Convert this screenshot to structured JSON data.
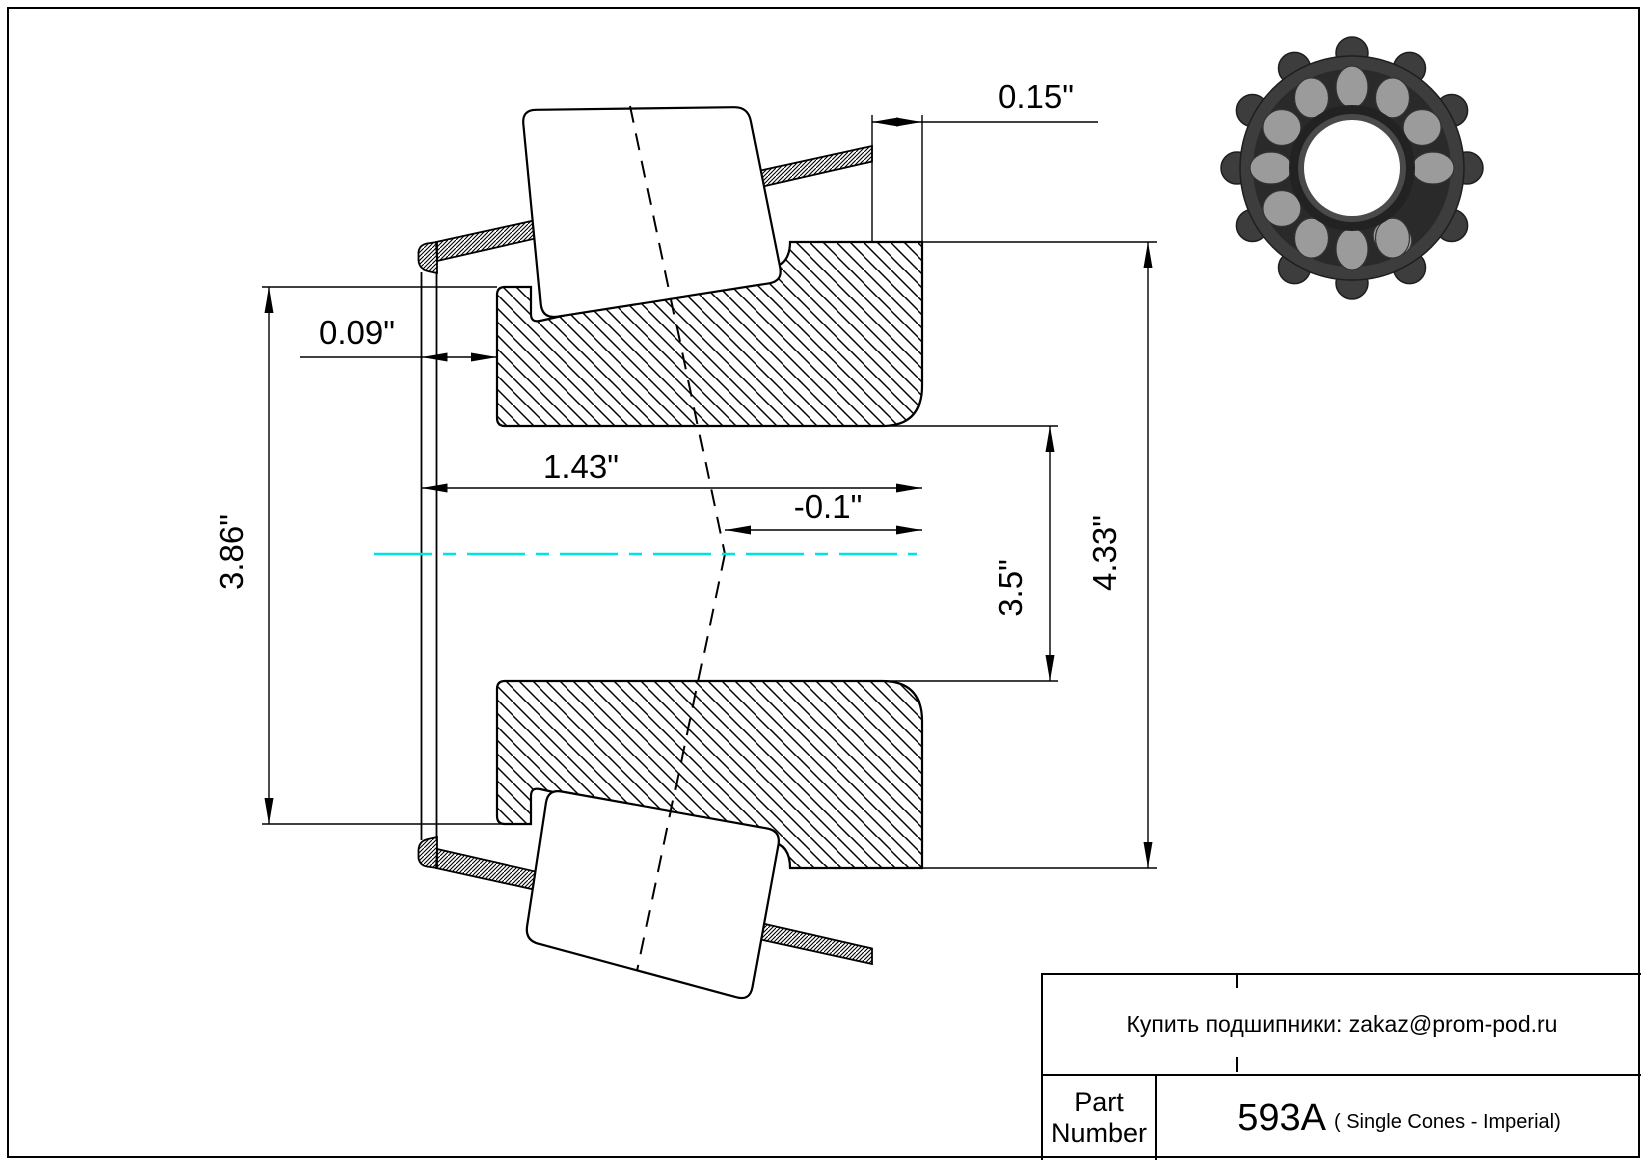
{
  "drawing": {
    "centerline_color": "#00e2e2",
    "dimensions": {
      "cage_overhang": "0.15\"",
      "front_face_offset": "0.09\"",
      "cone_width": "1.43\"",
      "effective_center": "-0.1\"",
      "cage_outer_diameter": "3.86\"",
      "bore_diameter": "3.5\"",
      "outer_diameter": "4.33\""
    }
  },
  "title_block": {
    "note": "Купить подшипники: zakaz@prom-pod.ru",
    "part_label": "Part Number",
    "part_number": "593A",
    "part_type": "( Single Cones - Imperial)"
  }
}
